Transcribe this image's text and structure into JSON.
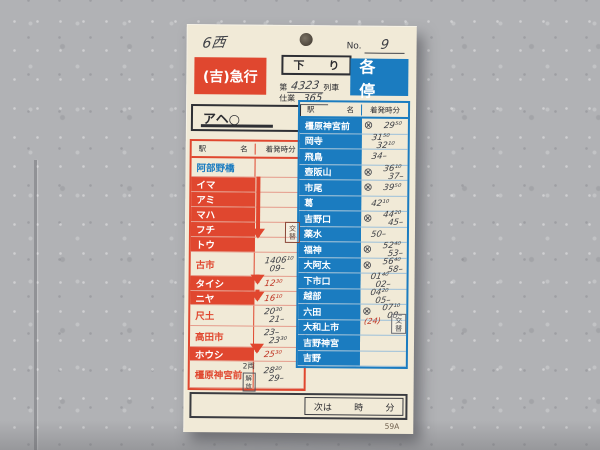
{
  "card": {
    "car_note": "6西",
    "serial": {
      "label": "No.",
      "value": "9"
    },
    "type_express": "(吉)急行",
    "direction": "下り",
    "train": {
      "prefix": "第",
      "number": "4323",
      "suffix": "列車"
    },
    "duty": {
      "label": "仕業",
      "value": "365"
    },
    "type_local": "各停",
    "origin": "アヘ○",
    "table_header": {
      "station1": "駅",
      "station2": "名",
      "time": "着発時分"
    },
    "left_table": {
      "rows": [
        {
          "name": "阿部野橋",
          "style": "blue-text"
        },
        {
          "name": "イマ",
          "style": "red-bg"
        },
        {
          "name": "アミ",
          "style": "red-bg"
        },
        {
          "name": "マハ",
          "style": "red-bg"
        },
        {
          "name": "フチ",
          "style": "red-bg"
        },
        {
          "name": "トウ",
          "style": "red-bg"
        },
        {
          "name": "古市",
          "style": "red-text",
          "t1": "1406¹⁰",
          "t2": "09–",
          "ink": "pencil"
        },
        {
          "name": "タイシ",
          "style": "red-bg",
          "t1": "12³⁰",
          "ink": "red"
        },
        {
          "name": "ニヤ",
          "style": "red-bg",
          "t1": "16¹⁰",
          "ink": "red"
        },
        {
          "name": "尺土",
          "style": "red-text",
          "t1": "20³⁰",
          "t2": "21–",
          "ink": "pencil"
        },
        {
          "name": "高田市",
          "style": "red-text",
          "t1": "23–",
          "t2": "23³⁰",
          "ink": "pencil"
        },
        {
          "name": "ホウシ",
          "style": "red-bg",
          "t1": "25³⁰",
          "ink": "red"
        },
        {
          "name": "橿原神宮前",
          "style": "red-text",
          "t1": "28²⁰",
          "t2": "29–",
          "ink": "pencil"
        }
      ]
    },
    "right_table": {
      "rows": [
        {
          "name": "橿原神宮前",
          "cross": true,
          "t1": "29⁵⁰"
        },
        {
          "name": "岡寺",
          "t1": "31⁵⁰",
          "t2": "32¹⁰"
        },
        {
          "name": "飛鳥",
          "t1": "34–"
        },
        {
          "name": "壺阪山",
          "cross": true,
          "t1": "36¹⁰",
          "t2": "37–"
        },
        {
          "name": "市尾",
          "cross": true,
          "t1": "39⁵⁰"
        },
        {
          "name": "葛",
          "t1": "42¹⁰"
        },
        {
          "name": "吉野口",
          "cross": true,
          "t1": "44²⁰",
          "t2": "45–"
        },
        {
          "name": "薬水",
          "t1": "50–"
        },
        {
          "name": "福神",
          "cross": true,
          "t1": "52⁴⁰",
          "t2": "53–"
        },
        {
          "name": "大阿太",
          "cross": true,
          "t1": "56⁴⁰",
          "t2": "58–"
        },
        {
          "name": "下市口",
          "t1": "01⁴⁰",
          "t2": "02–"
        },
        {
          "name": "越部",
          "t1": "04²⁰",
          "t2": "05–"
        },
        {
          "name": "六田",
          "cross": true,
          "t1": "07¹⁰",
          "t2": "08–",
          "red_note": "(24)"
        },
        {
          "name": "大和上市"
        },
        {
          "name": "吉野神宮"
        },
        {
          "name": "吉野"
        }
      ]
    },
    "uncouple_note": {
      "cars": "2両",
      "action": "解放"
    },
    "shift_note_left": "交替",
    "shift_note_right": "交替",
    "footer": {
      "next": "次は",
      "hour": "時",
      "minute": "分",
      "form_code": "59A"
    }
  },
  "colors": {
    "red": "#e0472f",
    "blue": "#1b7cc0",
    "card": "#f1ead7",
    "pencil": "#3e4046",
    "red_pen": "#bf3524"
  }
}
